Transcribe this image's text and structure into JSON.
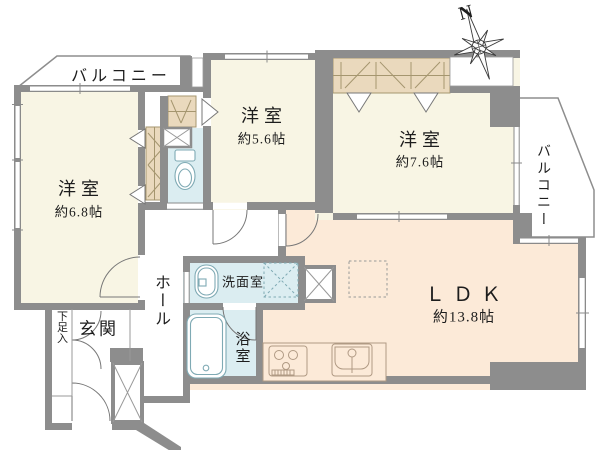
{
  "title": "マンション間取り図 (3LDK floor plan)",
  "compass": {
    "label": "N"
  },
  "rooms": {
    "balcony_top": {
      "label": "バルコニー"
    },
    "balcony_right": {
      "label": "バルコニー"
    },
    "bedroom_left": {
      "label": "洋室",
      "size": "約6.8帖"
    },
    "bedroom_middle": {
      "label": "洋室",
      "size": "約5.6帖"
    },
    "bedroom_right": {
      "label": "洋室",
      "size": "約7.6帖"
    },
    "ldk": {
      "label": "ＬＤＫ",
      "size": "約13.8帖"
    },
    "hall": {
      "label": "ホール"
    },
    "entrance": {
      "label": "玄関"
    },
    "shoe_storage": {
      "label": "下足入"
    },
    "washroom": {
      "label": "洗面室"
    },
    "bathroom": {
      "label": "浴室"
    }
  },
  "colors": {
    "wall": "#8d8d8d",
    "bedroom_fill": "#f8f5e4",
    "ldk_fill": "#fcead8",
    "wet_area_fill": "#dbedf1",
    "closet_fill": "#ead9bd",
    "line": "#8a8a8a"
  }
}
